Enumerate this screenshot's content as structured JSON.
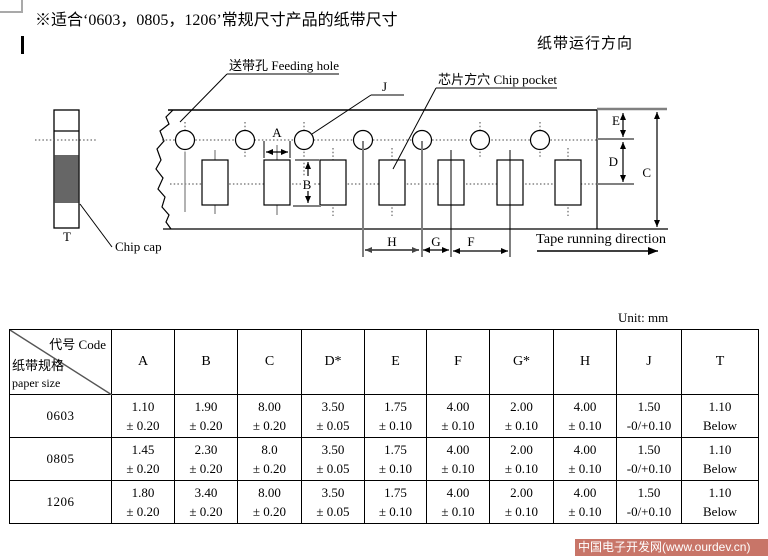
{
  "page": {
    "title": "※适合‘0603，0805，1206’常规尺寸产品的纸带尺寸",
    "direction_label_cn": "纸带运行方向",
    "unit_label": "Unit: mm",
    "watermark_text": "中国电子开发网(www.ourdev.cn)",
    "watermark_bg": "#c87568"
  },
  "diagram": {
    "callouts": {
      "feeding_hole": "送带孔 Feeding hole",
      "chip_pocket": "芯片方穴 Chip pocket",
      "chip_cap": "Chip cap",
      "tape_direction_en": "Tape running direction"
    },
    "dims": {
      "A": "A",
      "B": "B",
      "C": "C",
      "D": "D",
      "E": "E",
      "F": "F",
      "G": "G",
      "H": "H",
      "J": "J",
      "T": "T"
    }
  },
  "table": {
    "corner": {
      "top_right": "代号 Code",
      "mid_left": "纸带规格",
      "bottom_left": "paper size"
    },
    "headers": [
      "A",
      "B",
      "C",
      "D*",
      "E",
      "F",
      "G*",
      "H",
      "J",
      "T"
    ],
    "rows": [
      {
        "code": "0603",
        "cells": [
          [
            "1.10",
            "± 0.20"
          ],
          [
            "1.90",
            "± 0.20"
          ],
          [
            "8.00",
            "± 0.20"
          ],
          [
            "3.50",
            "± 0.05"
          ],
          [
            "1.75",
            "± 0.10"
          ],
          [
            "4.00",
            "± 0.10"
          ],
          [
            "2.00",
            "± 0.10"
          ],
          [
            "4.00",
            "± 0.10"
          ],
          [
            "1.50",
            "-0/+0.10"
          ],
          [
            "1.10",
            "Below"
          ]
        ]
      },
      {
        "code": "0805",
        "cells": [
          [
            "1.45",
            "± 0.20"
          ],
          [
            "2.30",
            "± 0.20"
          ],
          [
            "8.0",
            "± 0.20"
          ],
          [
            "3.50",
            "± 0.05"
          ],
          [
            "1.75",
            "± 0.10"
          ],
          [
            "4.00",
            "± 0.10"
          ],
          [
            "2.00",
            "± 0.10"
          ],
          [
            "4.00",
            "± 0.10"
          ],
          [
            "1.50",
            "-0/+0.10"
          ],
          [
            "1.10",
            "Below"
          ]
        ]
      },
      {
        "code": "1206",
        "cells": [
          [
            "1.80",
            "± 0.20"
          ],
          [
            "3.40",
            "± 0.20"
          ],
          [
            "8.00",
            "± 0.20"
          ],
          [
            "3.50",
            "± 0.05"
          ],
          [
            "1.75",
            "± 0.10"
          ],
          [
            "4.00",
            "± 0.10"
          ],
          [
            "2.00",
            "± 0.10"
          ],
          [
            "4.00",
            "± 0.10"
          ],
          [
            "1.50",
            "-0/+0.10"
          ],
          [
            "1.10",
            "Below"
          ]
        ]
      }
    ]
  }
}
